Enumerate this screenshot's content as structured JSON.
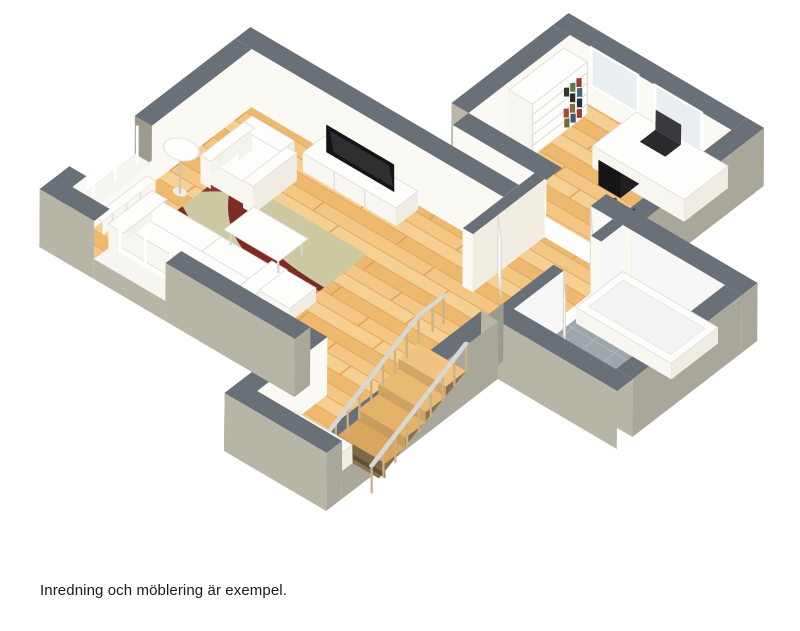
{
  "caption": {
    "text": "Inredning och möblering är exempel."
  },
  "scene": {
    "type": "3d-isometric-floor-plan-render",
    "rooms": [
      {
        "name": "living-room",
        "furniture": [
          "sofa",
          "armchair",
          "coffee-table",
          "ottoman",
          "patterned-rug",
          "floor-lamp",
          "tv-bench",
          "flat-screen-tv",
          "window-bay-radiator-west",
          "window-bay-radiator-south"
        ]
      },
      {
        "name": "hall",
        "furniture": [
          "staircase-descending",
          "stair-railing",
          "daybed",
          "interior-doors"
        ]
      },
      {
        "name": "home-office",
        "furniture": [
          "bookshelf-with-books",
          "desk",
          "laptop",
          "office-chair",
          "windows"
        ]
      },
      {
        "name": "bathroom",
        "furniture": [
          "bathtub",
          "toilet",
          "gray-tile-floor",
          "white-tiled-walls"
        ]
      }
    ],
    "palette": {
      "wall_top": "#6a7077",
      "wall_exterior_light": "#b7b5a6",
      "wall_exterior_dark": "#9c9a8c",
      "wall_interior": "#fbf9f4",
      "floor_wood": "#f0c07c",
      "floor_tile": "#9ea6ac",
      "rug_base": "#ccc8a2",
      "rug_accent_red": "#7e2b28",
      "rug_accent_tan": "#c09a72",
      "furniture_white": "#fdfdfc",
      "tv_black": "#141414",
      "stair_wood": "#e8b96f"
    }
  }
}
